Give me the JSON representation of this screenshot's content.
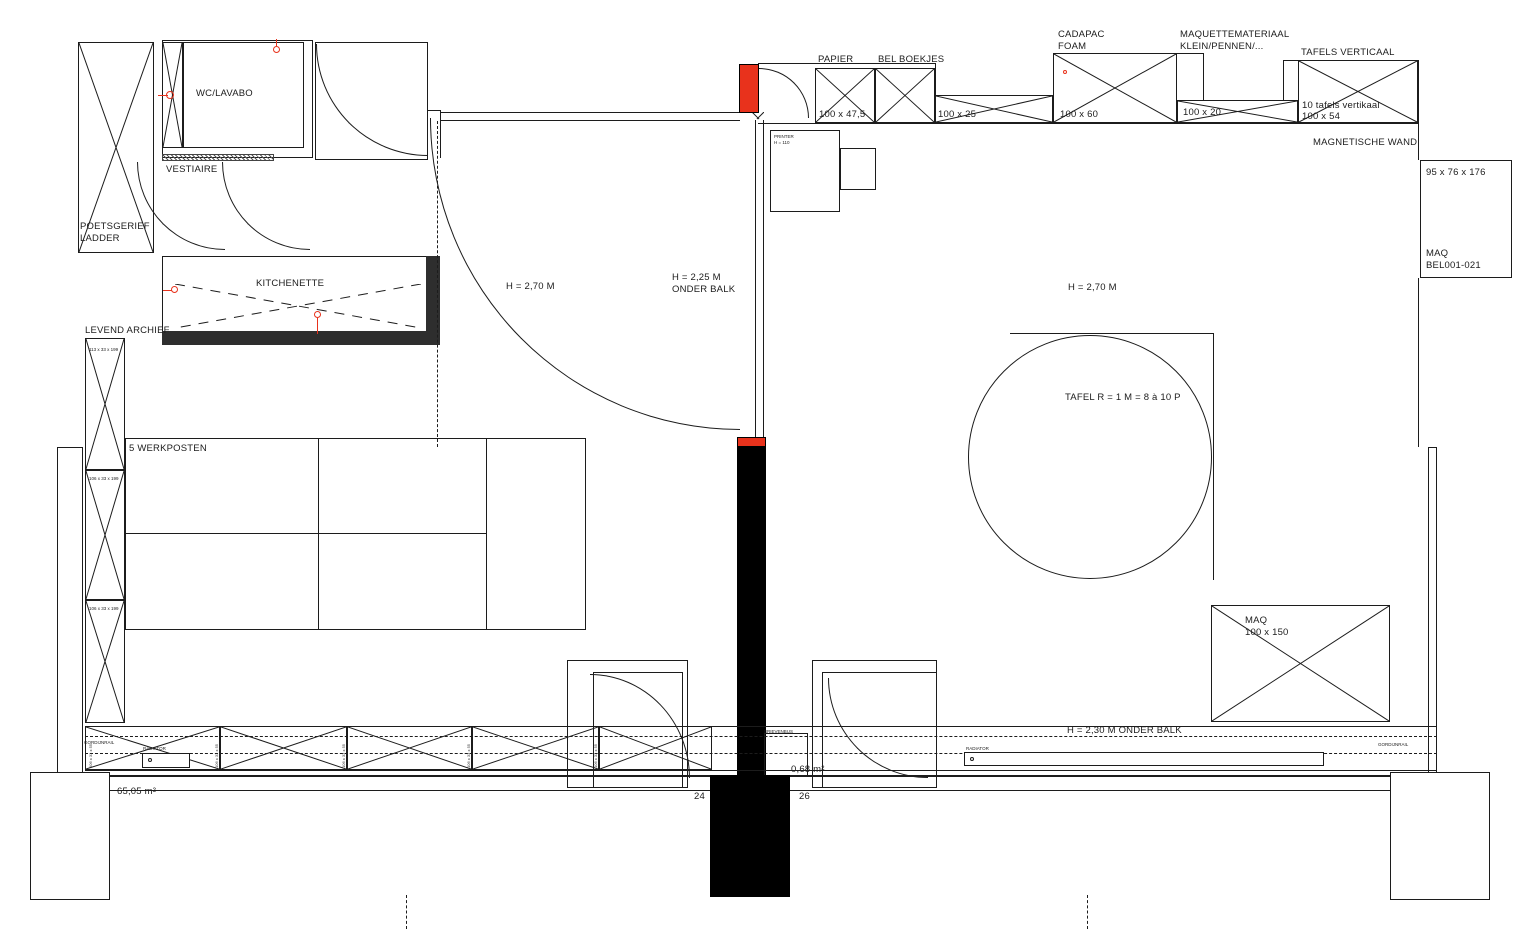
{
  "colors": {
    "line": "#1c1c1c",
    "accent_red": "#e8321c",
    "dark_wall": "#2e2e2e",
    "column_black": "#000000"
  },
  "labels": {
    "wc": "WC/LAVABO",
    "vestiaire": "VESTIAIRE",
    "poetsgerief_line1": "POETSGERIEF",
    "poetsgerief_line2": "LADDER",
    "kitchenette": "KITCHENETTE",
    "levend_archief": "LEVEND ARCHIEF",
    "archief_dim_1": "113 x 33 x 199",
    "archief_dim_2": "106 x 33 x 199",
    "archief_dim_3": "106 x 33 x 199",
    "werkposten": "5 WERKPOSTEN",
    "h_270_left": "H = 2,70 M",
    "h_225_line1": "H = 2,25 M",
    "h_225_line2": "ONDER BALK",
    "h_270_right": "H = 2,70 M",
    "tafel_rond": "TAFEL R = 1 M = 8 à 10 P",
    "papier": "PAPIER",
    "papier_dim": "100 x 47,5",
    "bel_boekjes": "BEL BOEKJES",
    "bel_dim": "100 x 25",
    "cadapac_line1": "CADAPAC",
    "cadapac_line2": "FOAM",
    "cadapac_dim": "100 x 60",
    "maquette_line1": "MAQUETTEMATERIAAL",
    "maquette_line2": "KLEIN/PENNEN/...",
    "maquette_dim": "100 x 20",
    "tafels_verticaal": "TAFELS VERTICAAL",
    "tafels_sub1": "10 tafels vertikaal",
    "tafels_sub2": "100 x 54",
    "magnetische_wand": "MAGNETISCHE WAND",
    "maq_shelf_dim": "95 x 76 x 176",
    "maq_shelf_line1": "MAQ",
    "maq_shelf_line2": "BEL001-021",
    "maq_table_line1": "MAQ",
    "maq_table_dim": "100 x 150",
    "printer_line1": "PRINTER",
    "printer_line2": "H = 110",
    "brievenbus": "BRIEVENBUS",
    "radiator": "RADIATOR",
    "gordijnrail": "GORDIJNRAIL",
    "h_230": "H = 2,30 M ONDER BALK",
    "area_total": "65,05 m²",
    "area_small": "0,68 m²",
    "grid_24": "24",
    "grid_26": "26",
    "sill_dim": "106 x 33 x 55"
  }
}
